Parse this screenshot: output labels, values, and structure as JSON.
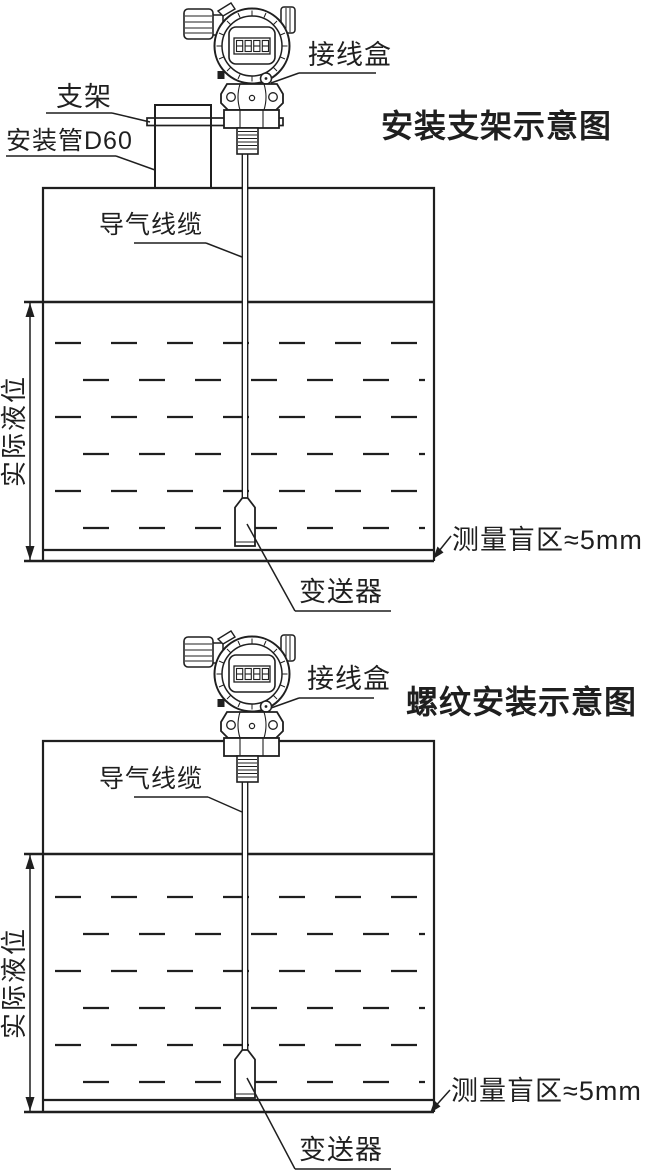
{
  "colors": {
    "line": "#1f1f1f",
    "background": "#ffffff"
  },
  "diagrams": [
    {
      "id": "bracket-installation",
      "title": "安装支架示意图",
      "labels": {
        "junction_box": "接线盒",
        "bracket": "支架",
        "mounting_pipe": "安装管D60",
        "air_cable": "导气线缆",
        "actual_level": "实际液位",
        "transmitter": "变送器",
        "blind_zone": "测量盲区≈5mm"
      }
    },
    {
      "id": "thread-installation",
      "title": "螺纹安装示意图",
      "labels": {
        "junction_box": "接线盒",
        "air_cable": "导气线缆",
        "actual_level": "实际液位",
        "transmitter": "变送器",
        "blind_zone": "测量盲区≈5mm"
      }
    }
  ]
}
